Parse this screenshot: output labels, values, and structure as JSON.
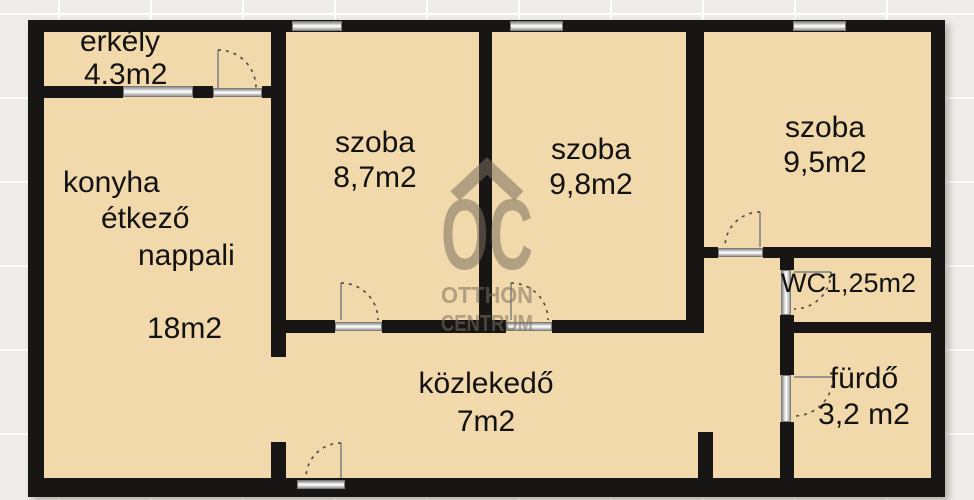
{
  "plan_title": "apartment floor plan",
  "rooms": {
    "erkely": {
      "name": "erkély",
      "area": "4.3m2"
    },
    "konyha": {
      "line1": "konyha",
      "line2": "étkező",
      "line3": "nappali",
      "area": "18m2"
    },
    "szoba_87": {
      "name": "szoba",
      "area": "8,7m2"
    },
    "szoba_98": {
      "name": "szoba",
      "area": "9,8m2"
    },
    "szoba_95": {
      "name": "szoba",
      "area": "9,5m2"
    },
    "wc": {
      "label": "WC1,25m2"
    },
    "furdo": {
      "name": "fürdő",
      "area": "3,2 m2"
    },
    "kozlekedo": {
      "name": "közlekedő",
      "area": "7m2"
    }
  },
  "watermark": {
    "logo": "OC",
    "line1": "OTTHON",
    "line2": "CENTRUM"
  },
  "colors": {
    "room_fill": "#f2d9ab",
    "wall": "#171614",
    "outside_bg": "#efedea",
    "window_gray": "#c9c9c9",
    "watermark": "#7a705c",
    "text": "#121212"
  }
}
